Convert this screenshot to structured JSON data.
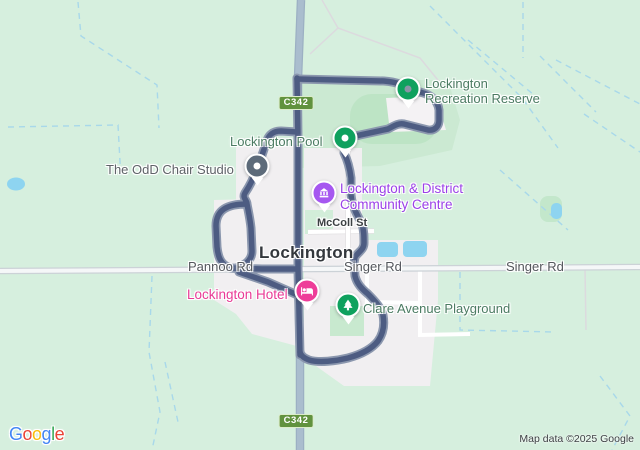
{
  "town": {
    "name": "Lockington"
  },
  "pois": {
    "recreation_reserve": {
      "line1": "Lockington",
      "line2": "Recreation Reserve"
    },
    "pool": {
      "label": "Lockington Pool"
    },
    "chair_studio": {
      "label": "The OdD Chair Studio"
    },
    "community_centre": {
      "line1": "Lockington & District",
      "line2": "Community Centre"
    },
    "hotel": {
      "label": "Lockington Hotel"
    },
    "playground": {
      "label": "Clare Avenue Playground"
    }
  },
  "roads": {
    "mccoll": "McColl St",
    "pannoo": "Pannoo Rd",
    "singer_town": "Singer Rd",
    "singer_east": "Singer Rd"
  },
  "shields": [
    {
      "label": "C342"
    },
    {
      "label": "C342"
    }
  ],
  "route": {
    "color": "#4d5c82",
    "casing_color": "#8b97ae",
    "segments": [
      {
        "d": "M297,78 L298,140 L298,268 L299,312 L300,355"
      },
      {
        "d": "M297,79 L338,80 L384,81 C396,82 403,84 407,90 L420,92 C432,95 438,101 439,110 L439,120 C439,127 434,131 428,130 L404,124 C398,123 394,126 388,129 L360,135 C350,137 346,140 345,146 L344,153 C348,161 350,170 351,178 L351,195 C352,206 357,215 362,224 C364,231 364,236 364,243 C364,250 358,252 355,257 L354,263 L355,276 C357,284 362,289 368,294 C376,302 381,308 383,315 C385,326 383,334 378,341 C371,350 359,355 348,358 C336,361 319,363 309,360 C304,358 301,356 300,352"
      },
      {
        "d": "M297,132 L281,131 C272,131 268,136 266,143 C263,153 260,161 257,169 C253,180 249,187 245,193 C242,198 247,200 247,204 C240,204 230,205 224,209 C218,213 216,219 216,226 L217,247 C218,256 220,262 226,266 C232,270 239,268 243,265 C249,262 252,257 252,251 L251,228 C250,218 248,210 247,204 M231,268 L262,269 L297,269 M239,272 L268,282 L302,297"
      }
    ]
  },
  "markers": [
    {
      "name": "recreation-reserve-marker",
      "style": "dot",
      "color": "#0fa15e",
      "dot_color": "#8a94a6"
    },
    {
      "name": "pool-marker",
      "style": "dot",
      "color": "#0fa15e",
      "dot_color": "#ffffff"
    },
    {
      "name": "chair-studio-marker",
      "style": "dot",
      "color": "#5d6b7a",
      "dot_color": "#ffffff"
    },
    {
      "name": "community-centre-marker",
      "style": "building-icon",
      "color": "#a657f0"
    },
    {
      "name": "hotel-marker",
      "style": "bed-icon",
      "color": "#ee3d99"
    },
    {
      "name": "playground-marker",
      "style": "tree-icon",
      "color": "#10a263"
    }
  ],
  "colors": {
    "land": "#d6efde",
    "park": "#cbe9d2",
    "sports_field": "#bde4c5",
    "town_area": "#f1eff1",
    "highway": "#a9bccd",
    "road_casing": "#ccd2d7",
    "road_fill": "#f5f7f8",
    "water": "#8ed4f0",
    "boundary_dash": "#a8d8ea",
    "poi_green_label": "#4b7b62",
    "poi_purple_label": "#9b40e8",
    "poi_pink_label": "#e93a96",
    "poi_gray_label": "#5f6368",
    "shield_green": "#61923e"
  },
  "attribution": "Map data ©2025 Google",
  "logo": {
    "letters": [
      {
        "ch": "G",
        "color": "#4285F4"
      },
      {
        "ch": "o",
        "color": "#EA4335"
      },
      {
        "ch": "o",
        "color": "#FBBC05"
      },
      {
        "ch": "g",
        "color": "#4285F4"
      },
      {
        "ch": "l",
        "color": "#34A853"
      },
      {
        "ch": "e",
        "color": "#EA4335"
      }
    ]
  }
}
